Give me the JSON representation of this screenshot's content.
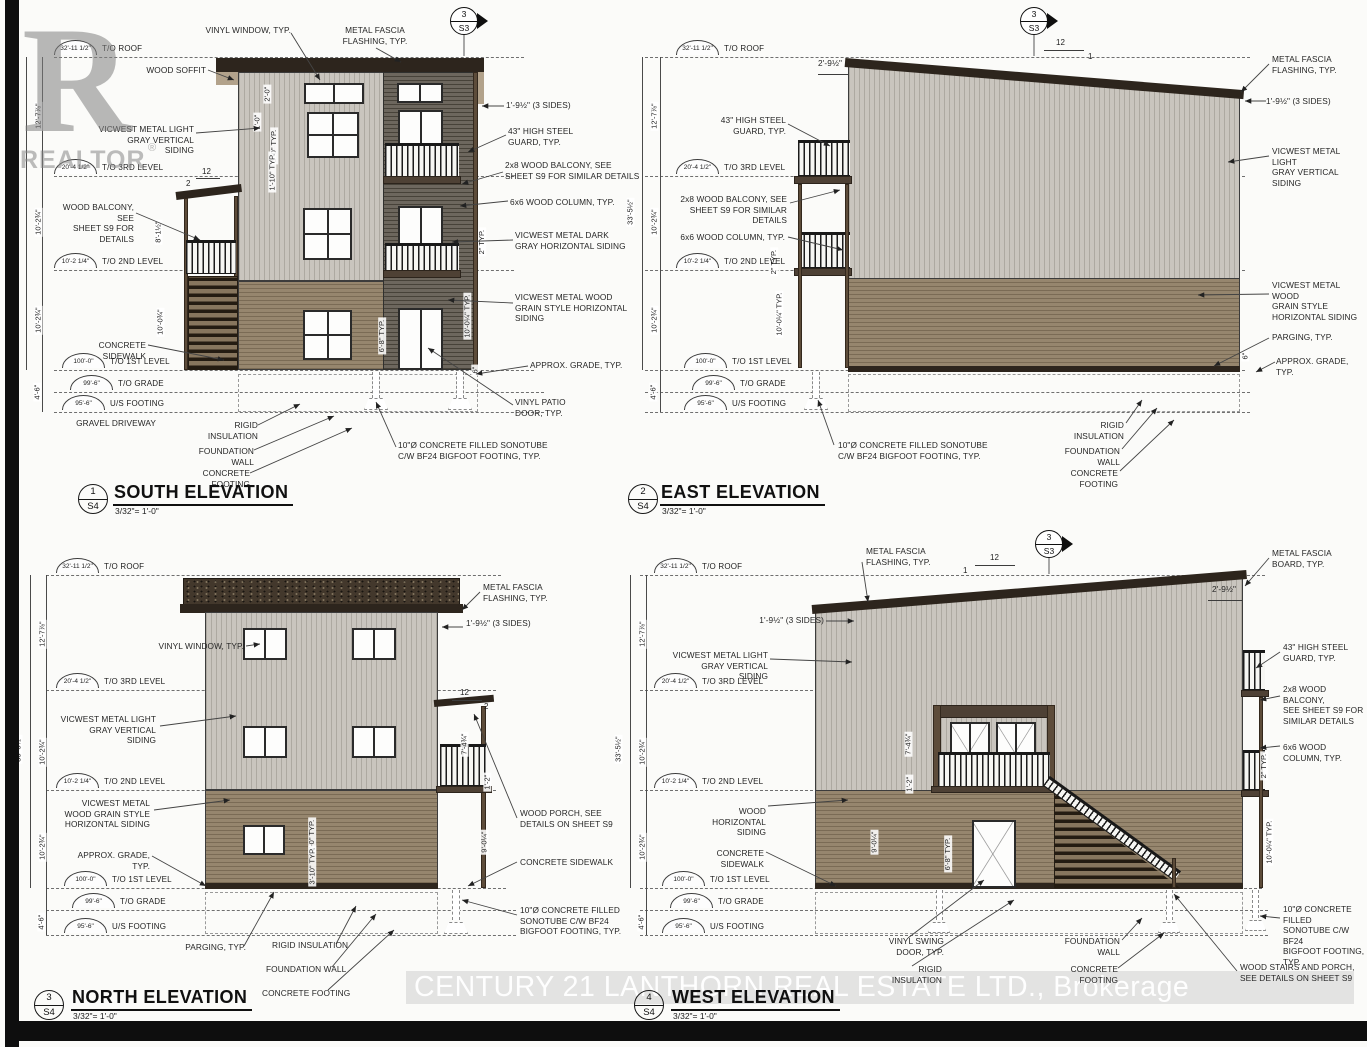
{
  "sheet": {
    "watermark_r": "R",
    "watermark_realtor": "REALTOR",
    "watermark_reg": "®",
    "watermark_brokerage": "CENTURY 21 LANTHORN REAL ESTATE LTD., Brokerage"
  },
  "section_marker": {
    "num": "3",
    "sheet": "S3"
  },
  "levels": [
    {
      "elev": "32'-11 1/2\"",
      "name": "T/O ROOF"
    },
    {
      "elev": "20'-4 1/2\"",
      "name": "T/O 3RD LEVEL"
    },
    {
      "elev": "10'-2 1/4\"",
      "name": "T/O 2ND LEVEL"
    },
    {
      "elev": "100'-0\"",
      "name": "T/O 1ST LEVEL"
    },
    {
      "elev": "99'-6\"",
      "name": "T/O GRADE"
    },
    {
      "elev": "95'-6\"",
      "name": "U/S FOOTING"
    }
  ],
  "dims": {
    "overall": "33'-5½\"",
    "roof3rd": "12'-7⅞\"",
    "floor": "10'-2¾\"",
    "belowgrade": "4'-6\"",
    "typfloor": "10'-0¼\" TYP.",
    "storey": "10'-0¾\"",
    "porch_ht": "8'-1½\"",
    "door_ht": "6'-8\" TYP.",
    "guard2": "2\" TYP.",
    "six": "6\"",
    "win2": "2'-0\"",
    "one_ft": "1'-0\"",
    "five_typ": "5'-0\" TYP.",
    "sill": "1'-10\" TYP.",
    "offset": "1'-9½\" (3 SIDES)",
    "fascia_offset": "2'-9½\"",
    "porch_roof": "7'-4¾\"",
    "rail_drop": "1'-2\"",
    "porch_clear": "9'-0¼\"",
    "win3": "3'-0\" TYP.",
    "win310": "3'-10\" TYP.",
    "twelve": "12",
    "one": "1",
    "two": "2"
  },
  "labels": {
    "vinyl_window": "VINYL WINDOW, TYP.",
    "metal_fascia_flashing": "METAL FASCIA\nFLASHING, TYP.",
    "metal_fascia_board": "METAL FASCIA\nBOARD, TYP.",
    "wood_soffit": "WOOD SOFFIT",
    "vicwest_light": "VICWEST METAL LIGHT\nGRAY VERTICAL SIDING",
    "vicwest_dark": "VICWEST METAL DARK\nGRAY HORIZONTAL SIDING",
    "vicwest_wood": "VICWEST METAL WOOD\nGRAIN STYLE HORIZONTAL\nSIDING",
    "vicwest_wood_e": "VICWEST METAL WOOD\nGRAIN STYLE\nHORIZONTAL SIDING",
    "vicwest_wood_n": "VICWEST METAL\nWOOD GRAIN STYLE\nHORIZONTAL SIDING",
    "wood_horizontal": "WOOD HORIZONTAL\nSIDING",
    "steel_guard": "43\" HIGH STEEL\nGUARD, TYP.",
    "balcony_2x8": "2x8 WOOD BALCONY, SEE\nSHEET S9 FOR SIMILAR DETAILS",
    "balcony_2x8_w": "2x8 WOOD BALCONY,\nSEE SHEET S9 FOR\nSIMILAR DETAILS",
    "wood_balcony": "WOOD BALCONY, SEE\nSHEET S9 FOR DETAILS",
    "wood_column": "6x6 WOOD COLUMN, TYP.",
    "concrete_sidewalk": "CONCRETE SIDEWALK",
    "approx_grade": "APPROX. GRADE, TYP.",
    "vinyl_patio_door": "VINYL PATIO\nDOOR, TYP.",
    "vinyl_swing_door": "VINYL SWING\nDOOR, TYP.",
    "sonotube2": "10\"Ø CONCRETE FILLED SONOTUBE\nC/W BF24 BIGFOOT FOOTING, TYP.",
    "sonotube3": "10\"Ø CONCRETE FILLED\nSONOTUBE C/W BF24\nBIGFOOT FOOTING, TYP.",
    "gravel_driveway": "GRAVEL DRIVEWAY",
    "rigid_insulation": "RIGID INSULATION",
    "foundation_wall": "FOUNDATION WALL",
    "concrete_footing": "CONCRETE FOOTING",
    "parging": "PARGING, TYP.",
    "wood_porch": "WOOD PORCH, SEE\nDETAILS ON SHEET S9",
    "wood_stairs": "WOOD STAIRS AND PORCH,\nSEE DETAILS ON SHEET S9"
  },
  "elevations": {
    "south": {
      "num": "1",
      "sheet": "S4",
      "title": "SOUTH ELEVATION",
      "scale": "3/32\"= 1'-0\""
    },
    "east": {
      "num": "2",
      "sheet": "S4",
      "title": "EAST ELEVATION",
      "scale": "3/32\"= 1'-0\""
    },
    "north": {
      "num": "3",
      "sheet": "S4",
      "title": "NORTH ELEVATION",
      "scale": "3/32\"= 1'-0\""
    },
    "west": {
      "num": "4",
      "sheet": "S4",
      "title": "WEST ELEVATION",
      "scale": "3/32\"= 1'-0\""
    }
  }
}
